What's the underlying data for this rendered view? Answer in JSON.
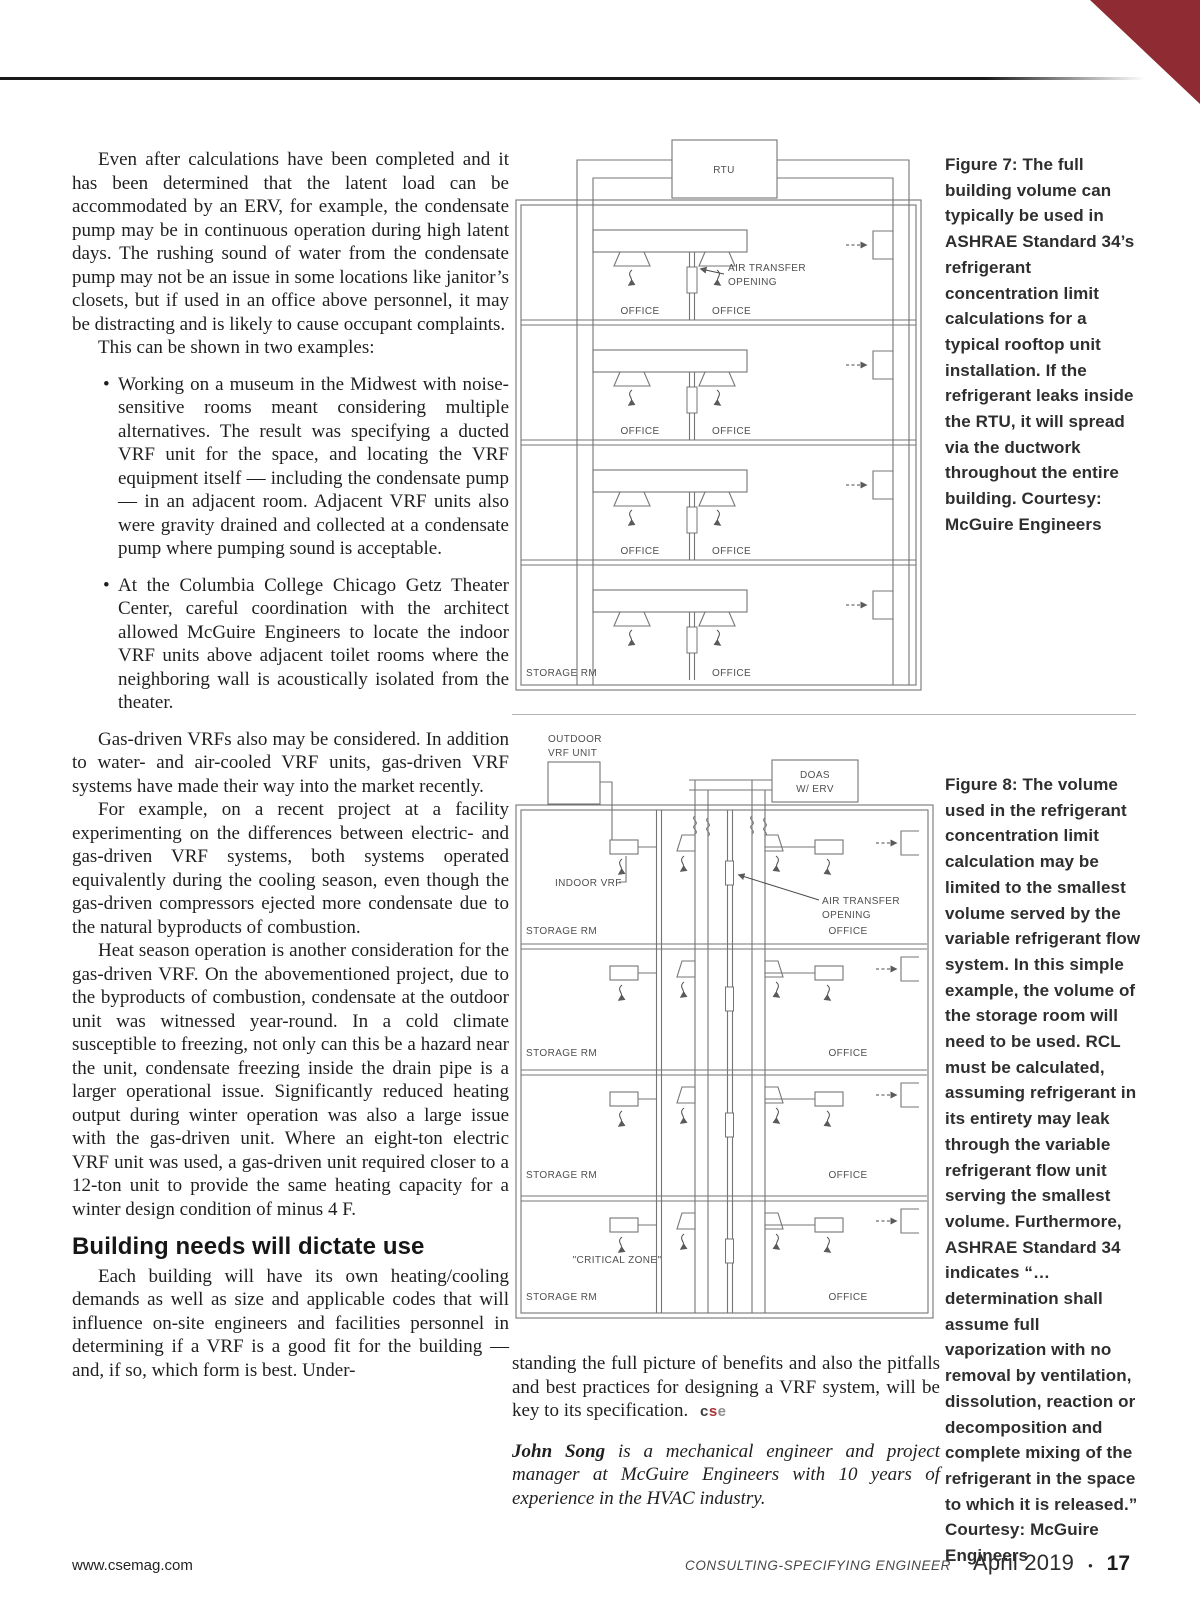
{
  "header": {
    "accent_color": "#8e2b33"
  },
  "article": {
    "p1": "Even after calculations have been completed and it has been determined that the latent load can be accommodated by an ERV, for example, the condensate pump may be in continuous operation during high latent days. The rushing sound of water from the condensate pump may not be an issue in some locations like janitor’s closets, but if used in an office above personnel, it may be distracting and is likely to cause occupant complaints.",
    "p2": "This can be shown in two examples:",
    "bullets": [
      "Working on a museum in the Midwest with noise-sensitive rooms meant considering multiple alternatives. The result was specifying a ducted VRF unit for the space, and locating the VRF equipment itself — including the condensate pump — in an adjacent room. Adjacent VRF units also were gravity drained and collected at a condensate pump where pumping sound is acceptable.",
      "At the Columbia College Chicago Getz Theater Center, careful coordination with the architect allowed McGuire Engineers to locate the indoor VRF units above adjacent toilet rooms where the neighboring wall is acoustically isolated from the theater."
    ],
    "p3": "Gas-driven VRFs also may be considered. In addition to water- and air-cooled VRF units, gas-driven VRF systems have made their way into the market recently.",
    "p4": "For example, on a recent project at a facility experimenting on the differences between electric- and gas-driven VRF systems, both systems operated equivalently during the cooling season, even though the gas-driven compressors ejected more condensate due to the natural byproducts of combustion.",
    "p5": "Heat season operation is another consideration for the gas-driven VRF. On the abovementioned project, due to the byproducts of combustion, condensate at the outdoor unit was witnessed year-round. In a cold climate susceptible to freezing, not only can this be a hazard near the unit, condensate freezing inside the drain pipe is a larger operational issue. Significantly reduced heating output during winter operation was also a large issue with the gas-driven unit. Where an eight-ton electric VRF unit was used, a gas-driven unit required closer to a 12-ton unit to provide the same heating capacity for a winter design condition of minus 4 F.",
    "heading": "Building needs will dictate use",
    "p6": "Each building will have its own heating/cooling demands as well as size and applicable codes that will influence on-site engineers and facilities personnel in determining if a VRF is a good fit for the building — and, if so, which form is best. Under-",
    "p7_continuation": "standing the full picture of benefits and also the pitfalls and best practices for designing a VRF system, will be key to its specification. ",
    "sign_off": {
      "c": "c",
      "s": "s",
      "e": "e"
    },
    "bio": {
      "name": "John Song",
      "text": " is a mechanical engineer and project manager at McGuire Engineers with 10 years of experience in the HVAC industry."
    }
  },
  "figure7": {
    "caption": "Figure 7: The full building volume can typically be used in ASHRAE Standard 34’s refrigerant concentration limit calculations for a typical rooftop unit installation. If the refrigerant leaks inside the RTU, it will spread via the ductwork throughout the entire building. Courtesy: McGuire Engineers",
    "labels": {
      "rtu": "RTU",
      "air_transfer_line1": "AIR TRANSFER",
      "air_transfer_line2": "OPENING"
    },
    "rooms": [
      {
        "left": "OFFICE",
        "right": "OFFICE"
      },
      {
        "left": "OFFICE",
        "right": "OFFICE"
      },
      {
        "left": "OFFICE",
        "right": "OFFICE"
      },
      {
        "left": "STORAGE RM",
        "right": "OFFICE"
      }
    ]
  },
  "figure8": {
    "caption": "Figure 8: The volume used in the refrigerant concentration limit calculation may be limited to the smallest volume served by the variable refrigerant flow system. In this simple example, the volume of the storage room will need to be used. RCL must be calculated, assuming refrigerant in its entirety may leak through the variable refrigerant flow unit serving the smallest volume. Furthermore, ASHRAE Standard 34 indicates “… determination shall assume full vaporization with no removal by ventilation, dissolution, reaction or decomposition and complete mixing of the refrigerant in the space to which it is released.” Courtesy: McGuire Engineers",
    "labels": {
      "outdoor_line1": "OUTDOOR",
      "outdoor_line2": "VRF UNIT",
      "doas_line1": "DOAS",
      "doas_line2": "W/ ERV",
      "indoor": "INDOOR VRF",
      "air_transfer_line1": "AIR TRANSFER",
      "air_transfer_line2": "OPENING",
      "critical_zone": "\"CRITICAL ZONE\""
    },
    "rooms": [
      {
        "left": "STORAGE RM",
        "right": "OFFICE"
      },
      {
        "left": "STORAGE RM",
        "right": "OFFICE"
      },
      {
        "left": "STORAGE RM",
        "right": "OFFICE"
      },
      {
        "left": "STORAGE RM",
        "right": "OFFICE"
      }
    ]
  },
  "footer": {
    "website": "www.csemag.com",
    "magazine": "CONSULTING-SPECIFYING ENGINEER",
    "issue": "April 2019",
    "separator": "•",
    "page_number": "17"
  }
}
